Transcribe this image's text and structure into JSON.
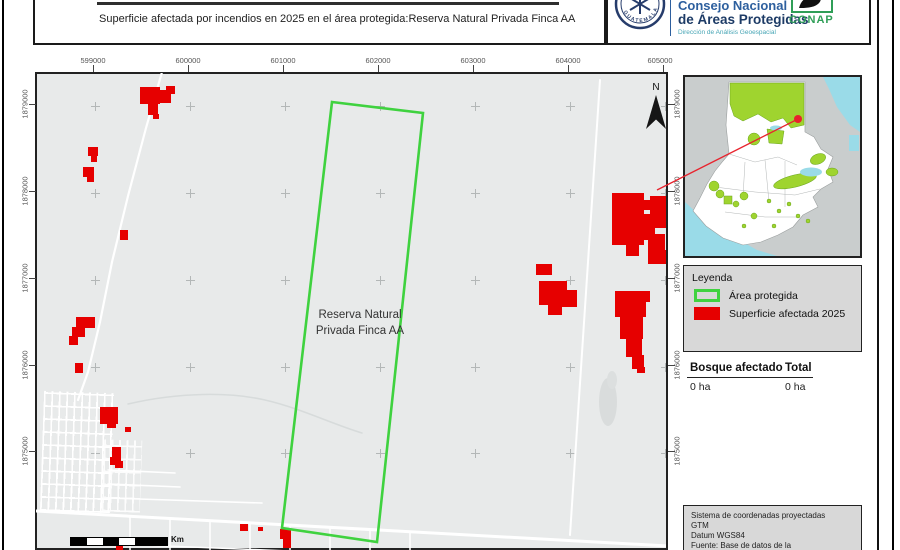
{
  "header": {
    "subtitle": "Superficie afectada por incendios en 2025 en el área protegida:Reserva Natural Privada Finca AA",
    "org_line1": "Consejo Nacional",
    "org_line2": "de Áreas Protegidas",
    "org_line3": "Dirección de Análisis Geoespacial",
    "conap_label": "CONAP",
    "seal_label": "GUATEMALA"
  },
  "map": {
    "x_ticks": [
      "599000",
      "600000",
      "601000",
      "602000",
      "603000",
      "604000",
      "605000"
    ],
    "y_ticks": [
      "1879000",
      "1878000",
      "1877000",
      "1876000",
      "1875000"
    ],
    "area_label_line1": "Reserva Natural",
    "area_label_line2": "Privada Finca AA",
    "north_label": "N",
    "scale_unit": "Km"
  },
  "legend": {
    "title": "Leyenda",
    "items": [
      {
        "label": "Área protegida",
        "swatch": "green-outline"
      },
      {
        "label": "Superficie afectada 2025",
        "swatch": "red-fill"
      }
    ]
  },
  "stats": {
    "col1_header": "Bosque afectado",
    "col2_header": "Total",
    "col1_value": "0 ha",
    "col2_value": "0 ha"
  },
  "footer": {
    "lines": [
      "Sistema de coordenadas proyectadas",
      "GTM",
      "Datum WGS84",
      "Fuente: Base de datos de la",
      "Dirección de Análisis Geoespacial"
    ]
  },
  "colors": {
    "fire_red": "#e60000",
    "protected_green": "#3fd23f",
    "inset_green": "#9fd42f",
    "water_cyan": "#9adbe8",
    "panel_gray": "#d8d8d8",
    "map_gray": "#e8eaea",
    "conap_green": "#2f9e57",
    "seal_navy": "#263c6b"
  }
}
